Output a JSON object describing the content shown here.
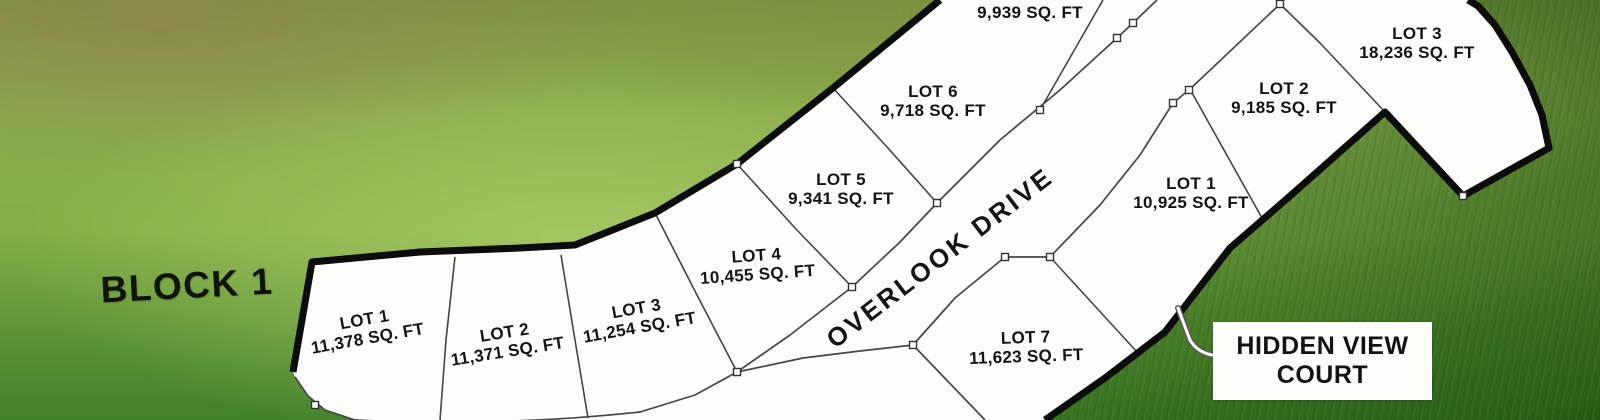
{
  "map": {
    "block_label": "BLOCK 1",
    "road_label": "OVERLOOK DRIVE",
    "court_label_line1": "HIDDEN VIEW",
    "court_label_line2": "COURT",
    "lots": [
      {
        "block": "1",
        "name": "LOT 1",
        "area": "11,378 SQ. FT"
      },
      {
        "block": "1",
        "name": "LOT 2",
        "area": "11,371 SQ. FT"
      },
      {
        "block": "1",
        "name": "LOT 3",
        "area": "11,254 SQ. FT"
      },
      {
        "block": "1",
        "name": "LOT 4",
        "area": "10,455 SQ. FT"
      },
      {
        "block": "1",
        "name": "LOT 5",
        "area": "9,341 SQ. FT"
      },
      {
        "block": "1",
        "name": "LOT 6",
        "area": "9,718 SQ. FT"
      },
      {
        "block": "1",
        "name": "LOT 7",
        "area": "9,939 SQ. FT"
      },
      {
        "block": "2",
        "name": "LOT 7",
        "area": "11,623 SQ. FT"
      },
      {
        "block": "2",
        "name": "LOT 1",
        "area": "10,925 SQ. FT"
      },
      {
        "block": "2",
        "name": "LOT 2",
        "area": "9,185 SQ. FT"
      },
      {
        "block": "2",
        "name": "LOT 3",
        "area": "18,236 SQ. FT"
      }
    ],
    "colors": {
      "plat_fill": "#fdfdfb",
      "boundary": "#0c0c0c",
      "lot_line": "#454545",
      "grass_light": "#8aad4c",
      "grass_dark": "#41812a"
    }
  }
}
